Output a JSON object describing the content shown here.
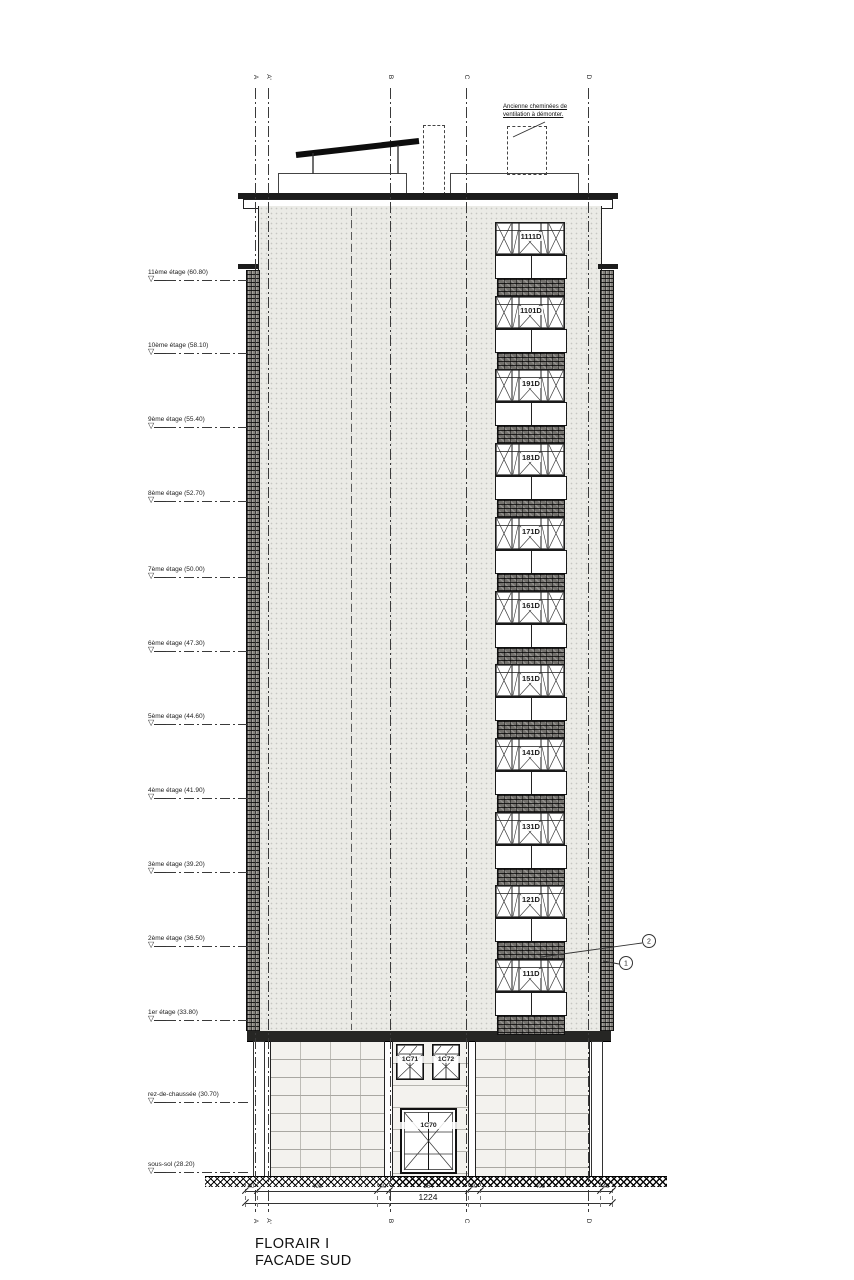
{
  "title": {
    "line1": "FLORAIR I",
    "line2": "FACADE SUD"
  },
  "roof_annotation": {
    "line1": "Ancienne cheminées de",
    "line2": "ventilation à démonter."
  },
  "floor_markers": [
    {
      "label": "11ème étage (60.80)",
      "y": 278
    },
    {
      "label": "10ème étage (58.10)",
      "y": 351
    },
    {
      "label": "9ème étage (55.40)",
      "y": 425
    },
    {
      "label": "8ème étage (52.70)",
      "y": 499
    },
    {
      "label": "7ème étage (50.00)",
      "y": 575
    },
    {
      "label": "6ème étage (47.30)",
      "y": 649
    },
    {
      "label": "5ème étage (44.60)",
      "y": 722
    },
    {
      "label": "4ème étage (41.90)",
      "y": 796
    },
    {
      "label": "3ème étage (39.20)",
      "y": 870
    },
    {
      "label": "2ème étage (36.50)",
      "y": 944
    },
    {
      "label": "1er étage (33.80)",
      "y": 1018
    },
    {
      "label": "rez-de-chaussée (30.70)",
      "y": 1100
    },
    {
      "label": "sous-sol (28.20)",
      "y": 1170
    }
  ],
  "grid_lines": [
    {
      "label": "A",
      "x": 255
    },
    {
      "label": "A'",
      "x": 268
    },
    {
      "label": "B",
      "x": 390
    },
    {
      "label": "C",
      "x": 466
    },
    {
      "label": "D",
      "x": 588
    }
  ],
  "tower_windows": [
    "1111D",
    "1101D",
    "191D",
    "181D",
    "171D",
    "161D",
    "151D",
    "141D",
    "131D",
    "121D",
    "111D"
  ],
  "ground_floor": {
    "window_left": "1C71",
    "window_right": "1C72",
    "door": "1C70"
  },
  "callouts": [
    {
      "num": "2"
    },
    {
      "num": "1"
    }
  ],
  "dimensions": {
    "segments": [
      "40",
      "400",
      "40",
      "264",
      "40",
      "400",
      "40"
    ],
    "total": "1224"
  },
  "colors": {
    "line": "#222222",
    "facade": "#ebebe6",
    "brick": "#73716d",
    "masonry": "#f3f2ee"
  }
}
